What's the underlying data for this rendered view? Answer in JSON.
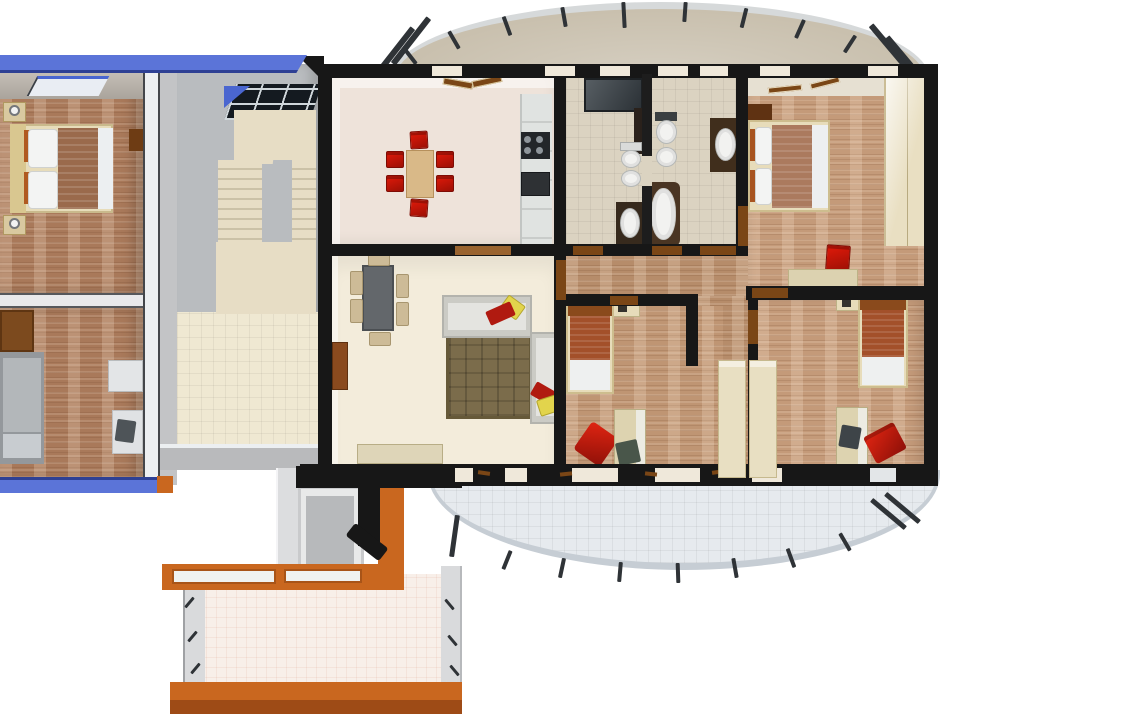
{
  "scene": {
    "title": "3D top-down apartment floor plan render",
    "type": "architectural-3d-floor-plan",
    "background": "#ffffff",
    "visible_text": "none"
  },
  "palette": {
    "wall-black": "#171717",
    "wall-blue": "#5b74d8",
    "wall-blue-edge": "#2e4094",
    "wall-orange": "#c9671f",
    "wall-orange-dark": "#9e4b16",
    "wood-left": "#a9795a",
    "wood-main": "#bf9573",
    "wood-corridor": "#b68c6a",
    "wood-tr": "#c49a79",
    "floor-kitchen": "#eee3da",
    "floor-living": "#f3ecdb",
    "floor-bath": "#dbd3c1",
    "floor-hall-cream": "#efe8d2",
    "floor-terrace": "#f8efe9",
    "stairs-cream": "#e7ddc5",
    "stairwell-gray": "#b9bcbf",
    "balcony-top": "#c9c0ae",
    "balcony-rim": "#d6d9da",
    "balcony-bottom": "#e6eaee",
    "balcony-bottom-edge": "#c6cdd4",
    "railing": "#2f3337",
    "accent-red": "#c81508",
    "accent-yellow": "#e2d44c",
    "sofa-gray": "#cbcbc5",
    "sofa-seat": "#e4e4e0",
    "rug-brown": "#7b6c4b",
    "furniture-cream": "#e7dcba",
    "door-brown": "#7a4616",
    "fixture-white": "#f2f2f0"
  },
  "rooms": [
    {
      "id": "bedroom-left-upper",
      "label": "bedroom (left apartment)",
      "floor": "wood"
    },
    {
      "id": "room-left-lower",
      "label": "bedroom (left apartment)",
      "floor": "wood"
    },
    {
      "id": "stairwell",
      "label": "stairwell with U-shaped stairs and skylight",
      "floor": "gray"
    },
    {
      "id": "entry-hall",
      "label": "entry hall",
      "floor": "cream tile"
    },
    {
      "id": "entry-vestibule",
      "label": "entry vestibule with orange walls",
      "floor": "gray"
    },
    {
      "id": "kitchen-dining",
      "label": "kitchen / dining room",
      "floor": "cream tile"
    },
    {
      "id": "bathroom-small",
      "label": "bathroom with shower, toilet, bidet, sink",
      "floor": "beige tile"
    },
    {
      "id": "bathroom-main",
      "label": "bathroom with bathtub, toilet, bidet, vanity",
      "floor": "beige tile"
    },
    {
      "id": "bedroom-top-right",
      "label": "master bedroom with double bed and wardrobe",
      "floor": "wood"
    },
    {
      "id": "hallway",
      "label": "hallway",
      "floor": "wood"
    },
    {
      "id": "bedroom-middle",
      "label": "single bedroom",
      "floor": "wood"
    },
    {
      "id": "bedroom-right",
      "label": "single bedroom",
      "floor": "wood"
    },
    {
      "id": "balcony-top",
      "label": "curved balcony with railing",
      "floor": "beige"
    },
    {
      "id": "balcony-bottom",
      "label": "curved balcony with railing",
      "floor": "gray tile"
    },
    {
      "id": "terrace",
      "label": "entry terrace with orange platform",
      "floor": "pink tile"
    }
  ],
  "furniture": {
    "bedroom-left-upper": [
      "double bed with white pillows and brown blanket",
      "2 nightstands with lamps",
      "wall cabinet",
      "skylight window"
    ],
    "room-left-lower": [
      "brown wardrobe",
      "gray bed",
      "white dresser",
      "desk with dark chair"
    ],
    "kitchen-dining": [
      "beige dining table",
      "6 red chairs",
      "kitchen counter",
      "stove with 4 burners",
      "oven",
      "open windows"
    ],
    "bathroom-small": [
      "shower stall",
      "toilet",
      "bidet",
      "dark vanity with sink"
    ],
    "bathroom-main": [
      "toilet",
      "bidet",
      "oval bathtub in brown surround",
      "dark vanity with oval sink"
    ],
    "bedroom-top-right": [
      "double bed",
      "dark nightstand",
      "cream wardrobe",
      "red chair",
      "desk"
    ],
    "bedroom-middle": [
      "single bed with orange blanket",
      "headboard shelf",
      "desk",
      "dark green chair",
      "red cushion"
    ],
    "bedroom-right": [
      "single bed with orange blanket",
      "headboard shelf",
      "desk",
      "dark chair",
      "red chair",
      "2 cream wardrobes"
    ],
    "living-room": [
      "gray dining table",
      "6 tan chairs",
      "two gray sofas",
      "brown patterned rug",
      "red and yellow pillows",
      "cream sideboard",
      "open door"
    ]
  }
}
